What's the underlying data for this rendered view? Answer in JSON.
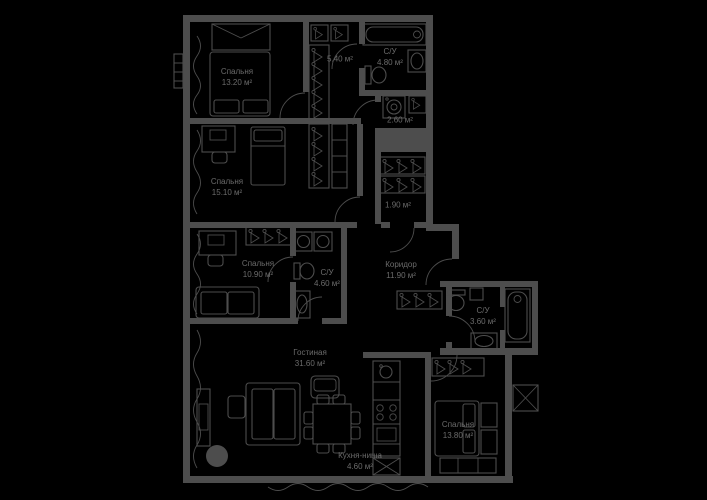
{
  "plan": {
    "background_color": "#000000",
    "wall_color": "#4d4d4d",
    "text_color": "#6b6b6b"
  },
  "rooms": [
    {
      "id": "bedroom-1",
      "name": "Спальня",
      "area": "13.20 м²"
    },
    {
      "id": "hallway",
      "name": "",
      "area": "5.40 м²"
    },
    {
      "id": "bathroom-1",
      "name": "С/У",
      "area": "4.80 м²"
    },
    {
      "id": "laundry",
      "name": "",
      "area": "2.60 м²"
    },
    {
      "id": "wardrobe",
      "name": "",
      "area": "1.90 м²"
    },
    {
      "id": "bedroom-2",
      "name": "Спальня",
      "area": "15.10 м²"
    },
    {
      "id": "bedroom-3",
      "name": "Спальня",
      "area": "10.90 м²"
    },
    {
      "id": "bathroom-2",
      "name": "С/У",
      "area": "4.60 м²"
    },
    {
      "id": "corridor",
      "name": "Коридор",
      "area": "11.90 м²"
    },
    {
      "id": "bathroom-3",
      "name": "С/У",
      "area": "3.60 м²"
    },
    {
      "id": "living-room",
      "name": "Гостиная",
      "area": "31.60 м²"
    },
    {
      "id": "kitchen-niche",
      "name": "Кухня-ниша",
      "area": "4.60 м²"
    },
    {
      "id": "bedroom-4",
      "name": "Спальня",
      "area": "13.80 м²"
    }
  ]
}
